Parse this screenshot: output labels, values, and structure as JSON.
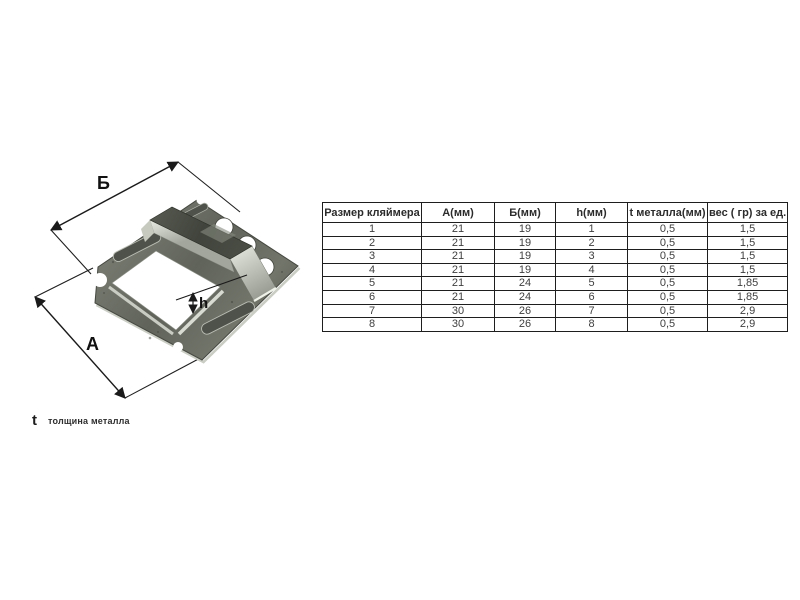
{
  "figure": {
    "dim_width_label": "Б",
    "dim_depth_label": "А",
    "dim_height_label": "h",
    "note": {
      "symbol": "t",
      "text": "толщина металла"
    }
  },
  "table": {
    "headers": [
      "Размер кляймера",
      "А(мм)",
      "Б(мм)",
      "h(мм)",
      "t металла(мм)",
      "вес ( гр) за ед."
    ],
    "rows": [
      [
        "1",
        "21",
        "19",
        "1",
        "0,5",
        "1,5"
      ],
      [
        "2",
        "21",
        "19",
        "2",
        "0,5",
        "1,5"
      ],
      [
        "3",
        "21",
        "19",
        "3",
        "0,5",
        "1,5"
      ],
      [
        "4",
        "21",
        "19",
        "4",
        "0,5",
        "1,5"
      ],
      [
        "5",
        "21",
        "24",
        "5",
        "0,5",
        "1,85"
      ],
      [
        "6",
        "21",
        "24",
        "6",
        "0,5",
        "1,85"
      ],
      [
        "7",
        "30",
        "26",
        "7",
        "0,5",
        "2,9"
      ],
      [
        "8",
        "30",
        "26",
        "8",
        "0,5",
        "2,9"
      ]
    ]
  },
  "colors": {
    "metal_base": "#6e7166",
    "metal_dark": "#4a4d44",
    "metal_bright": "#ced2c8",
    "annotation": "#1a1a1a",
    "table_border": "#1e1e1e",
    "table_text": "#3f3f3f"
  }
}
